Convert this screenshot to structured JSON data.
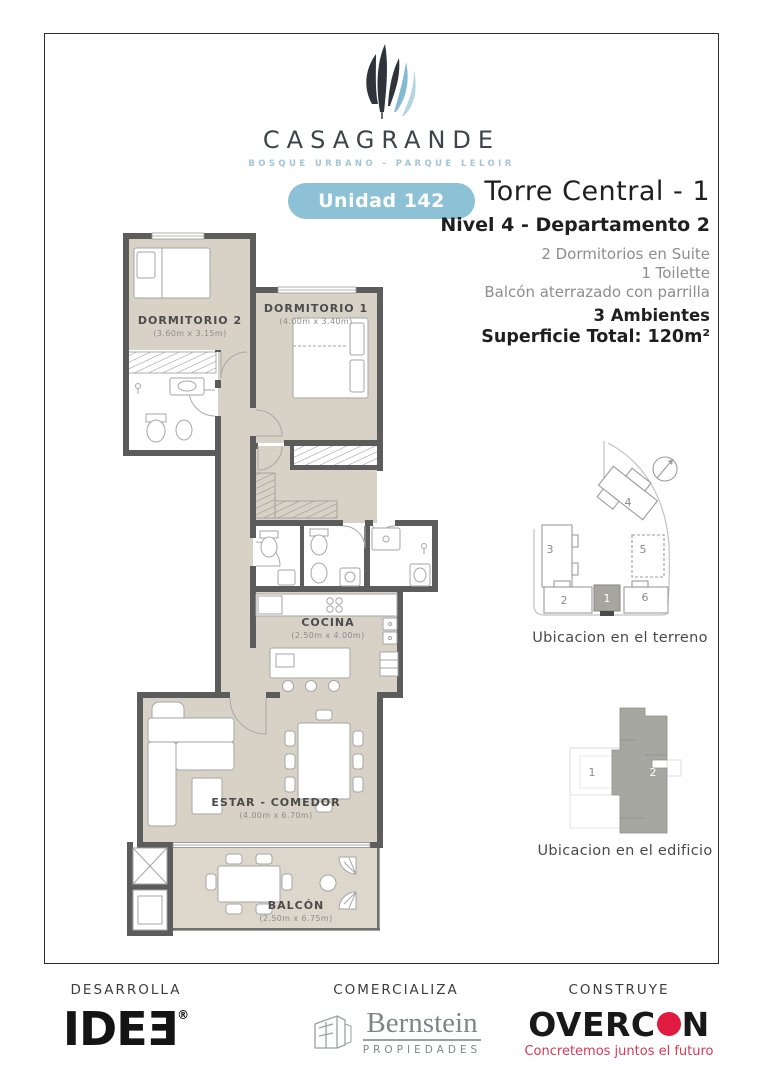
{
  "brand": {
    "name": "CASAGRANDE",
    "tagline": "BOSQUE URBANO - PARQUE LELOIR",
    "unit_badge": "Unidad 142"
  },
  "header": {
    "title": "Torre Central - 1",
    "subtitle": "Nivel 4 - Departamento 2",
    "features": [
      "2 Dormitorios en Suite",
      "1 Toilette",
      "Balcón aterrazado con parrilla"
    ],
    "highlight1": "3 Ambientes",
    "highlight2": "Superficie Total: 120m²"
  },
  "floorplan": {
    "rooms": [
      {
        "name": "DORMITORIO 2",
        "dims": "(3.60m x 3.15m)"
      },
      {
        "name": "DORMITORIO 1",
        "dims": "(4.00m x 3.40m)"
      },
      {
        "name": "COCINA",
        "dims": "(2.50m x 4.00m)"
      },
      {
        "name": "ESTAR - COMEDOR",
        "dims": "(4.00m x 6.70m)"
      },
      {
        "name": "BALCÓN",
        "dims": "(2.50m x 6.75m)"
      }
    ]
  },
  "site_map": {
    "caption": "Ubicacion en el terreno",
    "buildings": [
      "1",
      "2",
      "3",
      "4",
      "5",
      "6"
    ],
    "highlighted_building": "1"
  },
  "building_map": {
    "caption": "Ubicacion en el edificio",
    "units": [
      "1",
      "2"
    ],
    "highlighted_unit": "2"
  },
  "footer": {
    "developer": {
      "role": "DESARROLLA",
      "logo": "IDEƎ",
      "reg": "®"
    },
    "broker": {
      "role": "COMERCIALIZA",
      "logo": "Bernstein",
      "logo_sub": "PROPIEDADES"
    },
    "builder": {
      "role": "CONSTRUYE",
      "logo_left": "OVERC",
      "logo_right": "N",
      "tagline": "Concretemos juntos el futuro"
    }
  },
  "colors": {
    "accent_blue": "#8cc1d6",
    "wall_gray": "#5c5c5c",
    "floor_beige": "#d8d1c5",
    "logo_red": "#e11b3f"
  }
}
